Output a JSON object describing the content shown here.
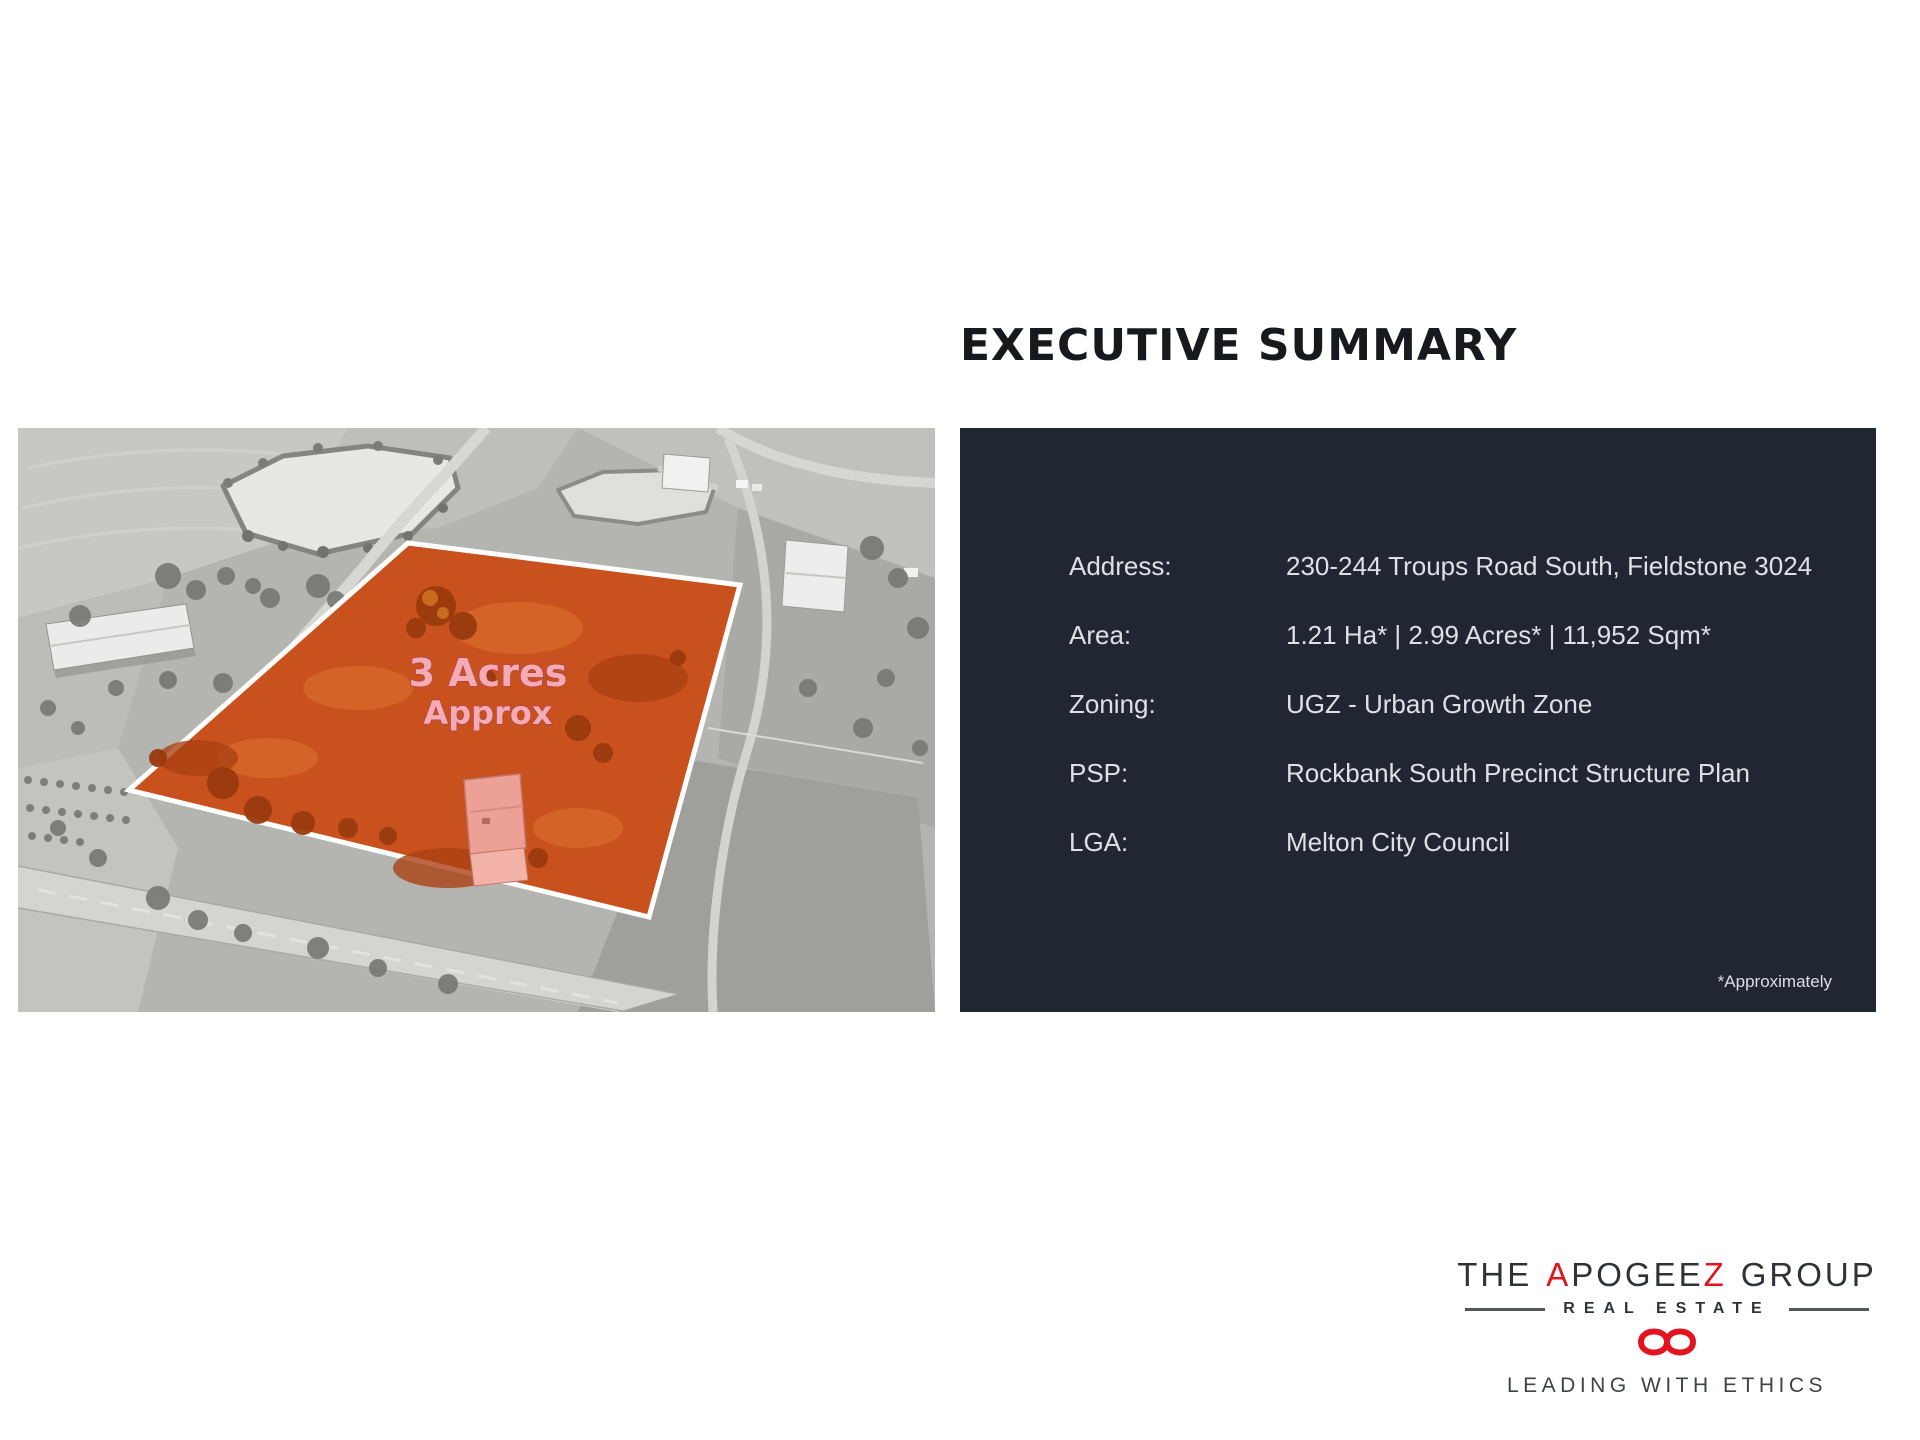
{
  "title": "EXECUTIVE SUMMARY",
  "photo": {
    "parcel_label_line1": "3 Acres",
    "parcel_label_line2": "Approx",
    "parcel_color": "#c8511d"
  },
  "summary_panel": {
    "background": "#212732",
    "text_color": "#dde1e7",
    "rows": [
      {
        "label": "Address:",
        "value": "230-244 Troups Road South, Fieldstone 3024"
      },
      {
        "label": "Area:",
        "value": "1.21 Ha* | 2.99 Acres* | 11,952 Sqm*"
      },
      {
        "label": "Zoning:",
        "value": "UGZ - Urban Growth Zone"
      },
      {
        "label": "PSP:",
        "value": "Rockbank South Precinct Structure Plan"
      },
      {
        "label": "LGA:",
        "value": "Melton City Council"
      }
    ],
    "footnote": "*Approximately"
  },
  "logo": {
    "line1_parts": [
      {
        "text": "THE",
        "color": "#2f3338"
      },
      {
        "text": "A",
        "color": "#e2141f"
      },
      {
        "text": "POGEE",
        "color": "#2f3338"
      },
      {
        "text": "Z",
        "color": "#e2141f"
      },
      {
        "text": "GROUP",
        "color": "#2f3338"
      }
    ],
    "line2": "REAL ESTATE",
    "tagline": "LEADING WITH ETHICS",
    "accent_red": "#e2141f"
  }
}
